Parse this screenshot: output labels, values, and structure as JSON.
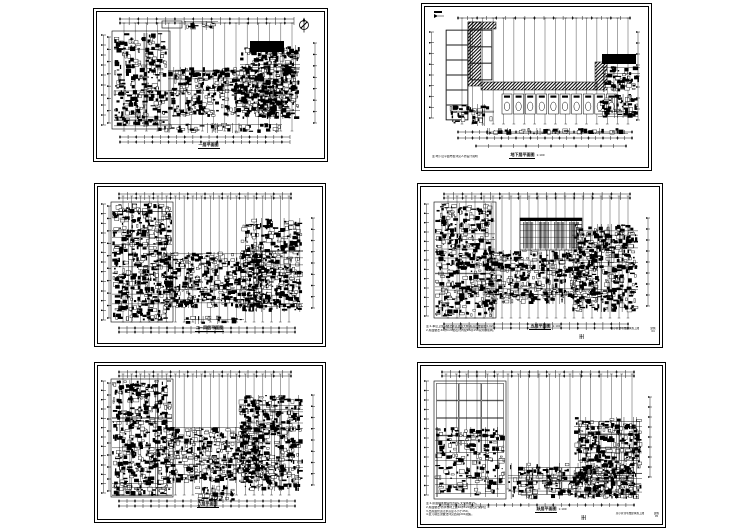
{
  "page": {
    "background": "#ffffff",
    "ink": "#000000",
    "description": "Montage of six architectural CAD floor plan sheets, 3 rows x 2 columns"
  },
  "panels": [
    {
      "name": "first-floor",
      "title": "一层平面图",
      "scale": "",
      "notes": [],
      "icons": [
        "north-arrow"
      ]
    },
    {
      "name": "basement-floor",
      "title": "地下层平面图",
      "scale": "1:100",
      "notes": [
        "注:地下层平面布置详见人防设计说明"
      ],
      "icons": [
        "exit-arrow"
      ]
    },
    {
      "name": "floors-2-4",
      "title": "二~四层平面图",
      "scale": "",
      "notes": [],
      "icons": []
    },
    {
      "name": "fifth-floor",
      "title": "五层平面图",
      "scale": "1:100",
      "notes": [
        "注:1.本层卫生间做法详见建施大样,标高比楼面低0.020。",
        "2.屋面做法:40厚C20细石砼内配Φ4@150双向钢筋网。"
      ],
      "titleblock": {
        "project": "某小区住宅楼建筑施工图",
        "sheet_label": "建施",
        "sheet_no": "04"
      },
      "icons": []
    },
    {
      "name": "sixth-floor",
      "title": "六层平面图",
      "scale": "",
      "notes": [],
      "icons": []
    },
    {
      "name": "top-floor",
      "title": "跃层平面图",
      "scale": "1:100",
      "notes": [
        "注:1.屋面排水坡度均为2%,天沟纵坡1%。",
        "2.屋面做法:防水卷材上做40厚C20细石砼保护层 ①",
        "3.出屋面管道泛水高度不小于250。",
        "4.女儿墙压顶做法详见西南J201图集。"
      ],
      "titleblock": {
        "project": "某小区住宅楼建筑施工图",
        "sheet_label": "建施",
        "sheet_no": "05"
      },
      "icons": []
    }
  ]
}
